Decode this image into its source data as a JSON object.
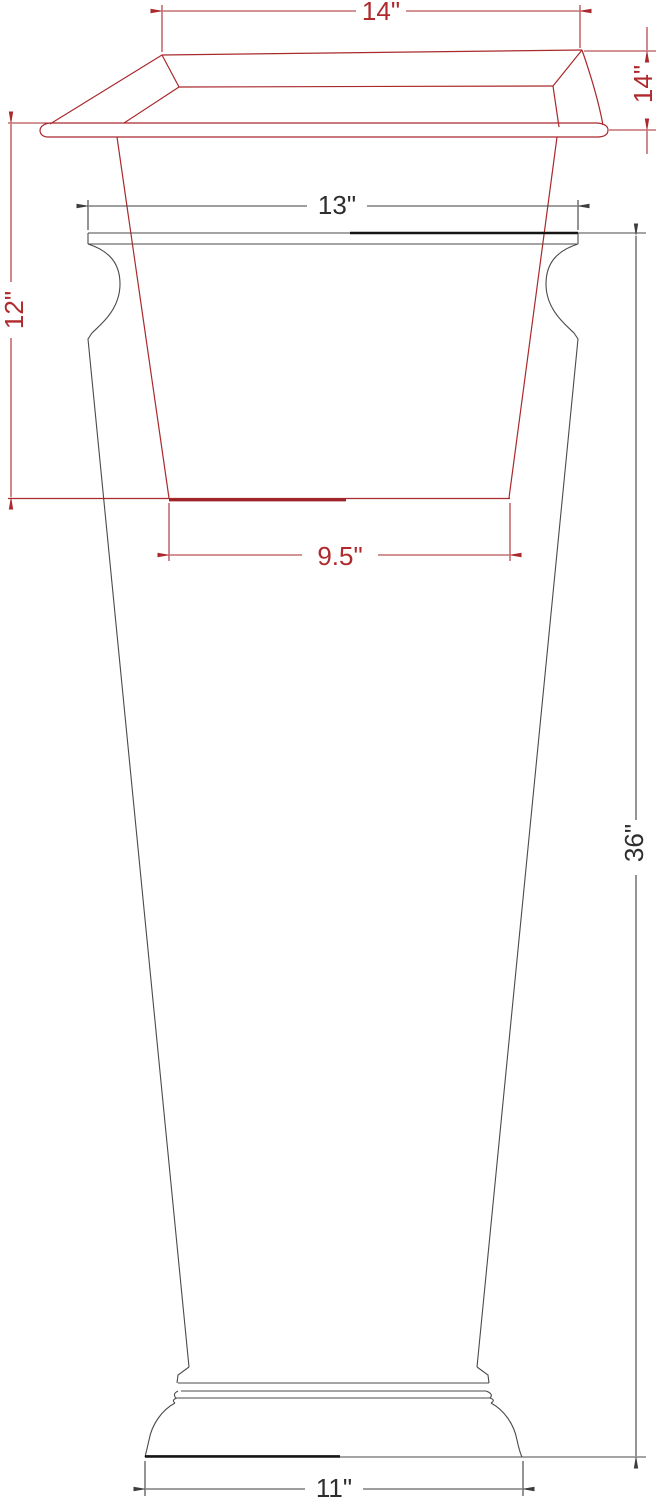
{
  "drawing": {
    "dims": {
      "rim_width": "14\"",
      "rim_overhang": "14\"",
      "opening": "13\"",
      "insert_depth": "12\"",
      "insert_bottom": "9.5\"",
      "height": "36\"",
      "base": "11\""
    },
    "colors": {
      "insert_line": "#a9292d",
      "vase_line": "#4a4a4a",
      "thick_edge": "#151515",
      "dim_text_red": "#b02a2d",
      "dim_text_black": "#2e2e2e",
      "background": "#ffffff"
    }
  }
}
